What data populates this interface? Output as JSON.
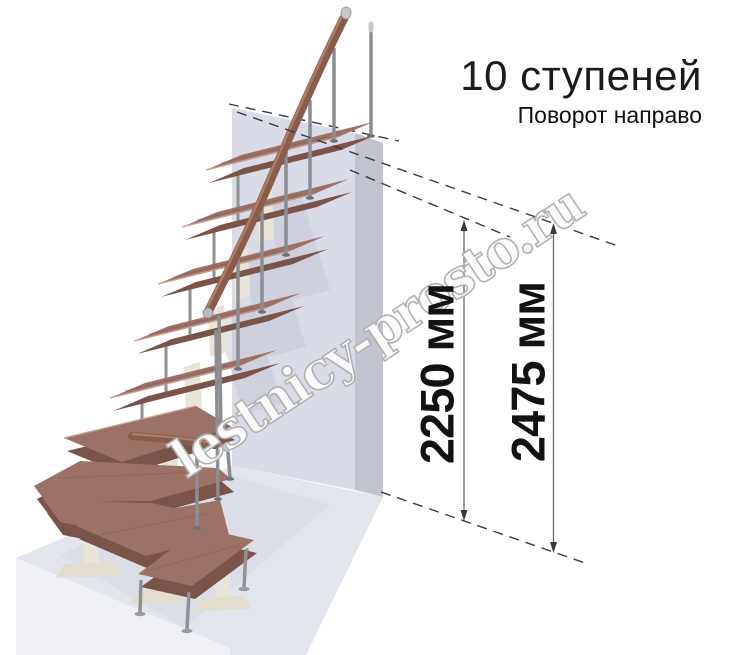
{
  "header": {
    "title": "10 ступеней",
    "subtitle": "Поворот направо"
  },
  "watermark": {
    "text": "lestnicy-prosto.ru"
  },
  "dimensions": [
    {
      "id": "height-to-top-step",
      "label": "2250 мм"
    },
    {
      "id": "total-height",
      "label": "2475 мм"
    }
  ],
  "diagram": {
    "type": "staircase-3d-render",
    "steps_count": 10,
    "turn_direction": "направо",
    "colors": {
      "step_wood_top": "#9c7166",
      "step_wood_front": "#7a5349",
      "handrail_wood": "#8b5c4c",
      "metal": "#8b8d91",
      "support_ivory": "#e9e4d7",
      "wall_front": "#d9dbe7",
      "wall_side": "#c1c3cf",
      "floor_top": "#e3e5ec",
      "reference_line": "#3b3b3b"
    }
  }
}
